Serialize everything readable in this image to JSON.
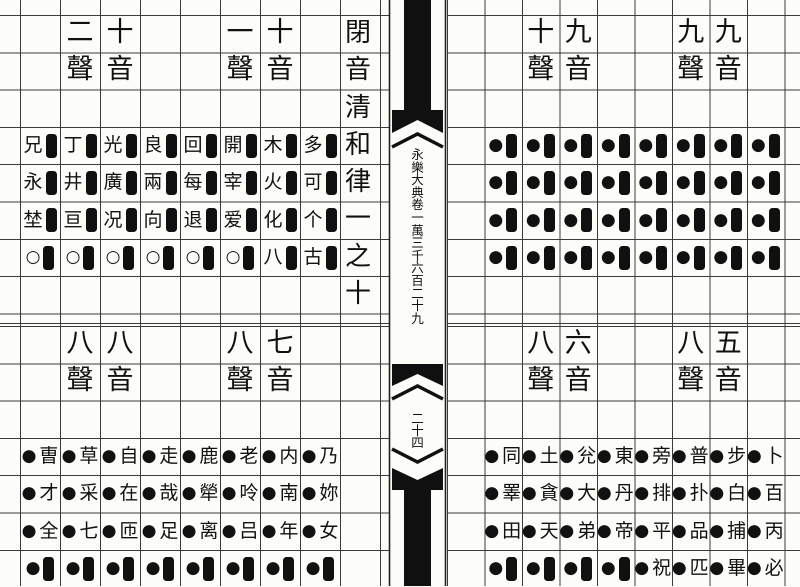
{
  "document": {
    "title_column": "閉音清和律一之十",
    "spine": {
      "volume_title": "永樂大典卷一萬三千六百二十九",
      "folio_number": "二十四"
    }
  },
  "blocks": [
    {
      "sheng": "二聲",
      "yin": "十音",
      "cells": [
        [
          "兄",
          "▮"
        ],
        [
          "丁",
          "▮"
        ],
        [
          "光",
          "▮"
        ],
        [
          "良",
          "▮"
        ],
        [
          "永",
          "▮"
        ],
        [
          "井",
          "▮"
        ],
        [
          "廣",
          "▮"
        ],
        [
          "兩",
          "▮"
        ],
        [
          "埜",
          "▮"
        ],
        [
          "亘",
          "▮"
        ],
        [
          "况",
          "▮"
        ],
        [
          "向",
          "▮"
        ],
        [
          "○",
          "▮"
        ],
        [
          "○",
          "▮"
        ],
        [
          "○",
          "▮"
        ],
        [
          "○",
          "▮"
        ]
      ]
    },
    {
      "sheng": "一聲",
      "yin": "十音",
      "cells": [
        [
          "回",
          "▮"
        ],
        [
          "開",
          "▮"
        ],
        [
          "木",
          "▮"
        ],
        [
          "多",
          "▮"
        ],
        [
          "每",
          "▮"
        ],
        [
          "宰",
          "▮"
        ],
        [
          "火",
          "▮"
        ],
        [
          "可",
          "▮"
        ],
        [
          "退",
          "▮"
        ],
        [
          "爱",
          "▮"
        ],
        [
          "化",
          "▮"
        ],
        [
          "个",
          "▮"
        ],
        [
          "○",
          "▮"
        ],
        [
          "○",
          "▮"
        ],
        [
          "八",
          "▮"
        ],
        [
          "古",
          "▮"
        ]
      ]
    },
    {
      "sheng": "十聲",
      "yin": "九音",
      "cells": [
        [
          "●",
          "▮"
        ],
        [
          "●",
          "▮"
        ],
        [
          "●",
          "▮"
        ],
        [
          "●",
          "▮"
        ],
        [
          "●",
          "▮"
        ],
        [
          "●",
          "▮"
        ],
        [
          "●",
          "▮"
        ],
        [
          "●",
          "▮"
        ],
        [
          "●",
          "▮"
        ],
        [
          "●",
          "▮"
        ],
        [
          "●",
          "▮"
        ],
        [
          "●",
          "▮"
        ],
        [
          "●",
          "▮"
        ],
        [
          "●",
          "▮"
        ],
        [
          "●",
          "▮"
        ],
        [
          "●",
          "▮"
        ]
      ]
    },
    {
      "sheng": "九聲",
      "yin": "九音",
      "cells": [
        [
          "●",
          "▮"
        ],
        [
          "●",
          "▮"
        ],
        [
          "●",
          "▮"
        ],
        [
          "●",
          "▮"
        ],
        [
          "●",
          "▮"
        ],
        [
          "●",
          "▮"
        ],
        [
          "●",
          "▮"
        ],
        [
          "●",
          "▮"
        ],
        [
          "●",
          "▮"
        ],
        [
          "●",
          "▮"
        ],
        [
          "●",
          "▮"
        ],
        [
          "●",
          "▮"
        ],
        [
          "●",
          "▮"
        ],
        [
          "●",
          "▮"
        ],
        [
          "●",
          "▮"
        ],
        [
          "●",
          "▮"
        ]
      ]
    },
    {
      "sheng": "八聲",
      "yin": "八音",
      "cells": [
        [
          "●",
          "曺"
        ],
        [
          "●",
          "草"
        ],
        [
          "●",
          "自"
        ],
        [
          "●",
          "走"
        ],
        [
          "●",
          "才"
        ],
        [
          "●",
          "采"
        ],
        [
          "●",
          "在"
        ],
        [
          "●",
          "哉"
        ],
        [
          "●",
          "全"
        ],
        [
          "●",
          "七"
        ],
        [
          "●",
          "匝"
        ],
        [
          "●",
          "足"
        ],
        [
          "●",
          "▮"
        ],
        [
          "●",
          "▮"
        ],
        [
          "●",
          "▮"
        ],
        [
          "●",
          "▮"
        ]
      ]
    },
    {
      "sheng": "八聲",
      "yin": "七音",
      "cells": [
        [
          "●",
          "鹿"
        ],
        [
          "●",
          "老"
        ],
        [
          "●",
          "内"
        ],
        [
          "●",
          "乃"
        ],
        [
          "●",
          "犖"
        ],
        [
          "●",
          "呤"
        ],
        [
          "●",
          "南"
        ],
        [
          "●",
          "妳"
        ],
        [
          "●",
          "离"
        ],
        [
          "●",
          "吕"
        ],
        [
          "●",
          "年"
        ],
        [
          "●",
          "女"
        ],
        [
          "●",
          "▮"
        ],
        [
          "●",
          "▮"
        ],
        [
          "●",
          "▮"
        ],
        [
          "●",
          "▮"
        ]
      ]
    },
    {
      "sheng": "八聲",
      "yin": "六音",
      "cells": [
        [
          "●",
          "同"
        ],
        [
          "●",
          "土"
        ],
        [
          "●",
          "兊"
        ],
        [
          "●",
          "東"
        ],
        [
          "●",
          "睪"
        ],
        [
          "●",
          "貪"
        ],
        [
          "●",
          "大"
        ],
        [
          "●",
          "丹"
        ],
        [
          "●",
          "田"
        ],
        [
          "●",
          "天"
        ],
        [
          "●",
          "弟"
        ],
        [
          "●",
          "帝"
        ],
        [
          "●",
          "▮"
        ],
        [
          "●",
          "▮"
        ],
        [
          "●",
          "▮"
        ],
        [
          "●",
          "▮"
        ]
      ]
    },
    {
      "sheng": "八聲",
      "yin": "五音",
      "cells": [
        [
          "●",
          "旁"
        ],
        [
          "●",
          "普"
        ],
        [
          "●",
          "步"
        ],
        [
          "●",
          "卜"
        ],
        [
          "●",
          "排"
        ],
        [
          "●",
          "扑"
        ],
        [
          "●",
          "白"
        ],
        [
          "●",
          "百"
        ],
        [
          "●",
          "平"
        ],
        [
          "●",
          "品"
        ],
        [
          "●",
          "捕"
        ],
        [
          "●",
          "丙"
        ],
        [
          "●",
          "祝"
        ],
        [
          "●",
          "匹"
        ],
        [
          "●",
          "畢"
        ],
        [
          "●",
          "必"
        ]
      ]
    }
  ]
}
